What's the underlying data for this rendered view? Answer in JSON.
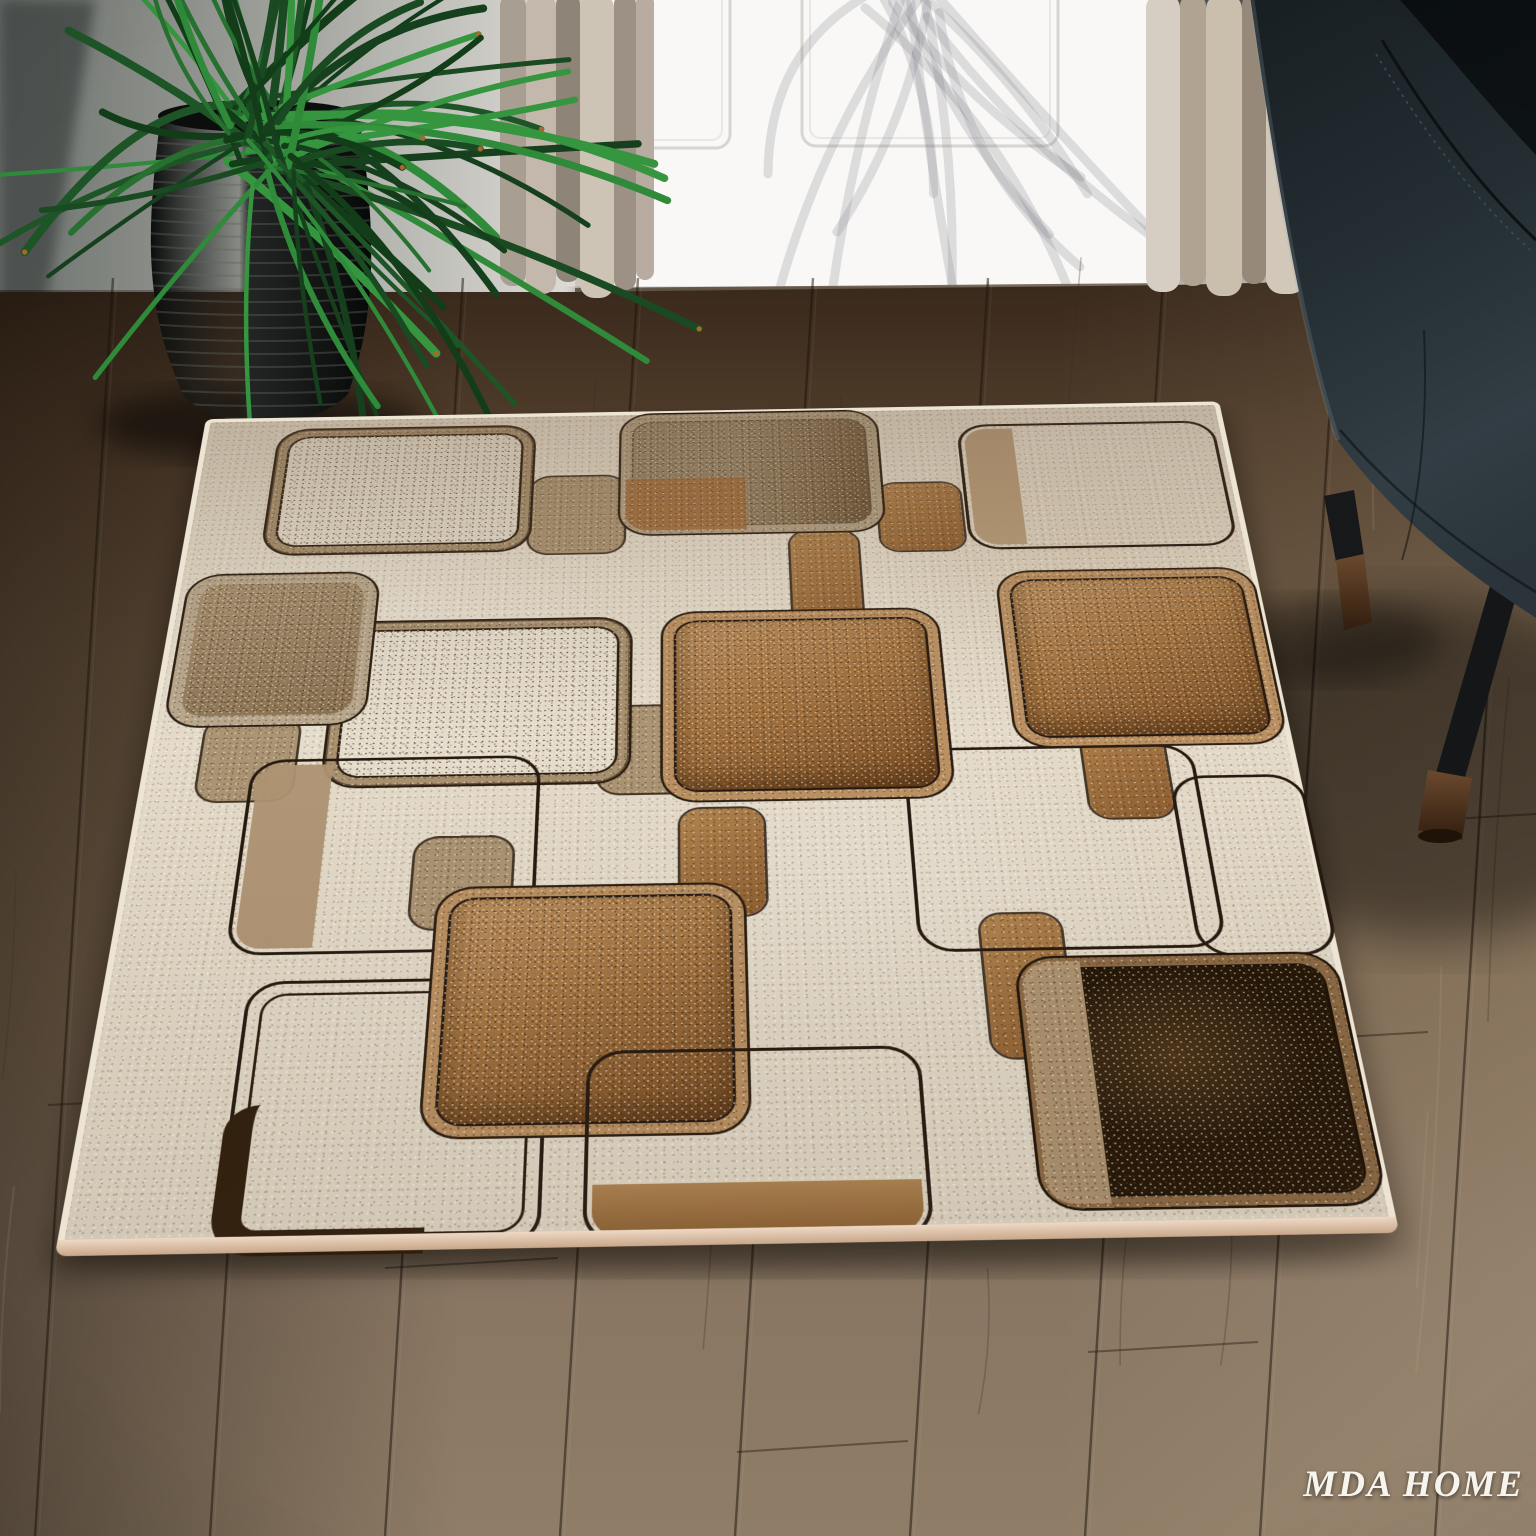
{
  "watermark": {
    "text": "MDA HOME"
  },
  "palette": {
    "rug_cream": "#e4dbca",
    "rug_tan_band": "#a8916f",
    "rug_caramel": "#a4743f",
    "rug_mottled_brown": "#9a8668",
    "rug_espresso": "#31200c",
    "rug_outline_dark": "#251910",
    "rug_binding": "#e0c9b2",
    "floor_wood_dark": "#3a2a1d",
    "floor_wood_light": "#8f7d67",
    "wall_gray": "#b5b5b0",
    "door_white": "#f9f8f6",
    "curtain_beige": "#c9bead",
    "chair_leather": "#242e33",
    "chair_leg_wood": "#4e3522",
    "plant_green": "#27702f",
    "planter_black": "#17191a"
  }
}
